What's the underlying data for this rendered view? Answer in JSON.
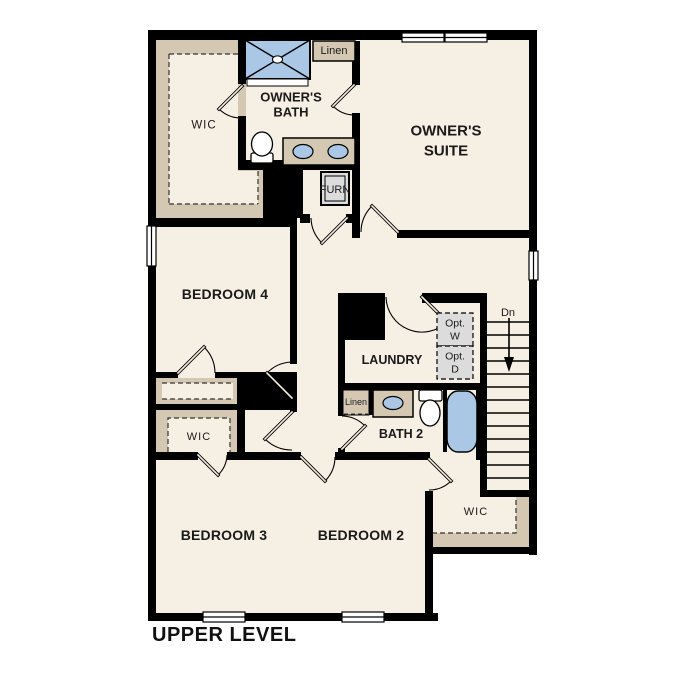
{
  "title": "UPPER LEVEL",
  "colors": {
    "wall": "#000000",
    "floor": "#f6efe3",
    "closet_tan": "#d5c8b2",
    "fixture_blue": "#aac8e6",
    "appliance_gray": "#dcdcdc",
    "background": "#ffffff"
  },
  "rooms": {
    "owners_suite": {
      "line1": "OWNER'S",
      "line2": "SUITE"
    },
    "owners_bath": {
      "line1": "OWNER'S",
      "line2": "BATH"
    },
    "owners_wic": {
      "label": "WIC"
    },
    "linen_upper": {
      "label": "Linen"
    },
    "furnace": {
      "label": "FURN"
    },
    "bedroom_4": {
      "label": "BEDROOM 4"
    },
    "laundry": {
      "label": "LAUNDRY"
    },
    "optional_washer": {
      "line1": "Opt.",
      "line2": "W"
    },
    "optional_dryer": {
      "line1": "Opt.",
      "line2": "D"
    },
    "stairs": {
      "label": "Dn"
    },
    "bath_2": {
      "label": "BATH 2"
    },
    "linen_bath_2": {
      "label": "Linen"
    },
    "wic_bedroom_3": {
      "label": "WIC"
    },
    "bedroom_3": {
      "label": "BEDROOM 3"
    },
    "bedroom_2": {
      "label": "BEDROOM 2"
    },
    "wic_bedroom_2": {
      "label": "WIC"
    }
  }
}
